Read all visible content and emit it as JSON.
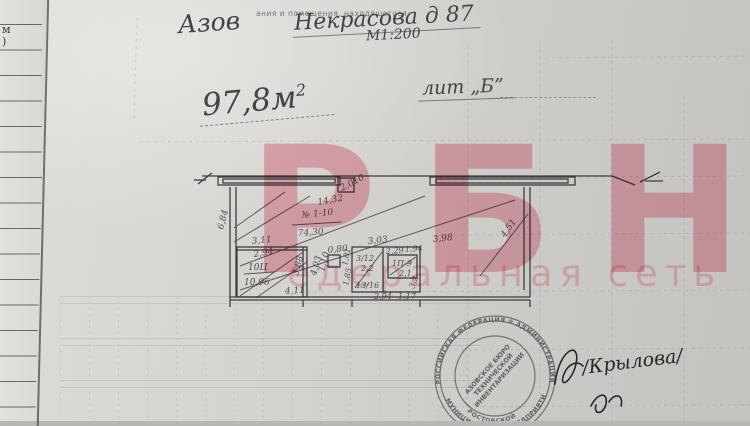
{
  "page": {
    "margin_fragments": {
      "f1": "м",
      "f2": ")"
    },
    "header": {
      "printed_caption": "ания и помещения, находящегося:",
      "city": "Азов",
      "address": "Некрасова д 87",
      "scale": "М1:200",
      "area_value": "97,8м",
      "area_sup": "2",
      "liter": "лит „Б”"
    },
    "watermark": {
      "line1": "РБН",
      "line2": "едеральная сеть",
      "color": "#f0829b"
    },
    "plan": {
      "dims": [
        "14,32",
        "№ 1-10",
        "74,30",
        "6,84",
        "2,010",
        "4,51",
        "3,11",
        "3,98",
        "2,94",
        "10Ц",
        "10,96",
        "3,88",
        "4,03",
        "0,80",
        "1,10",
        "4,11",
        "3,03",
        "2,29",
        "1,94",
        "3/12",
        "2,2",
        "1П-9",
        "2,1",
        "1,01",
        "1,85",
        "13/16",
        "2,94",
        "1,17",
        "3,2"
      ]
    },
    "stamp": {
      "ring_outer_top": "РОССИЙСКАЯ ФЕДЕРАЦИЯ ✻ АДМИНИСТРАЦИЯ",
      "ring_outer_bottom": "МУНИЦИПАЛЬНОЕ ПРЕДПРИЯТИЕ",
      "ring_inner_bottom": "РОСТОВСКОЙ",
      "center_line1": "АЗОВСКОЕ БЮРО",
      "center_line2": "ТЕХНИЧЕСКОЙ",
      "center_line3": "ИНВЕНТАРИЗАЦИИ"
    },
    "signature": {
      "name": "/Крылова/"
    }
  }
}
